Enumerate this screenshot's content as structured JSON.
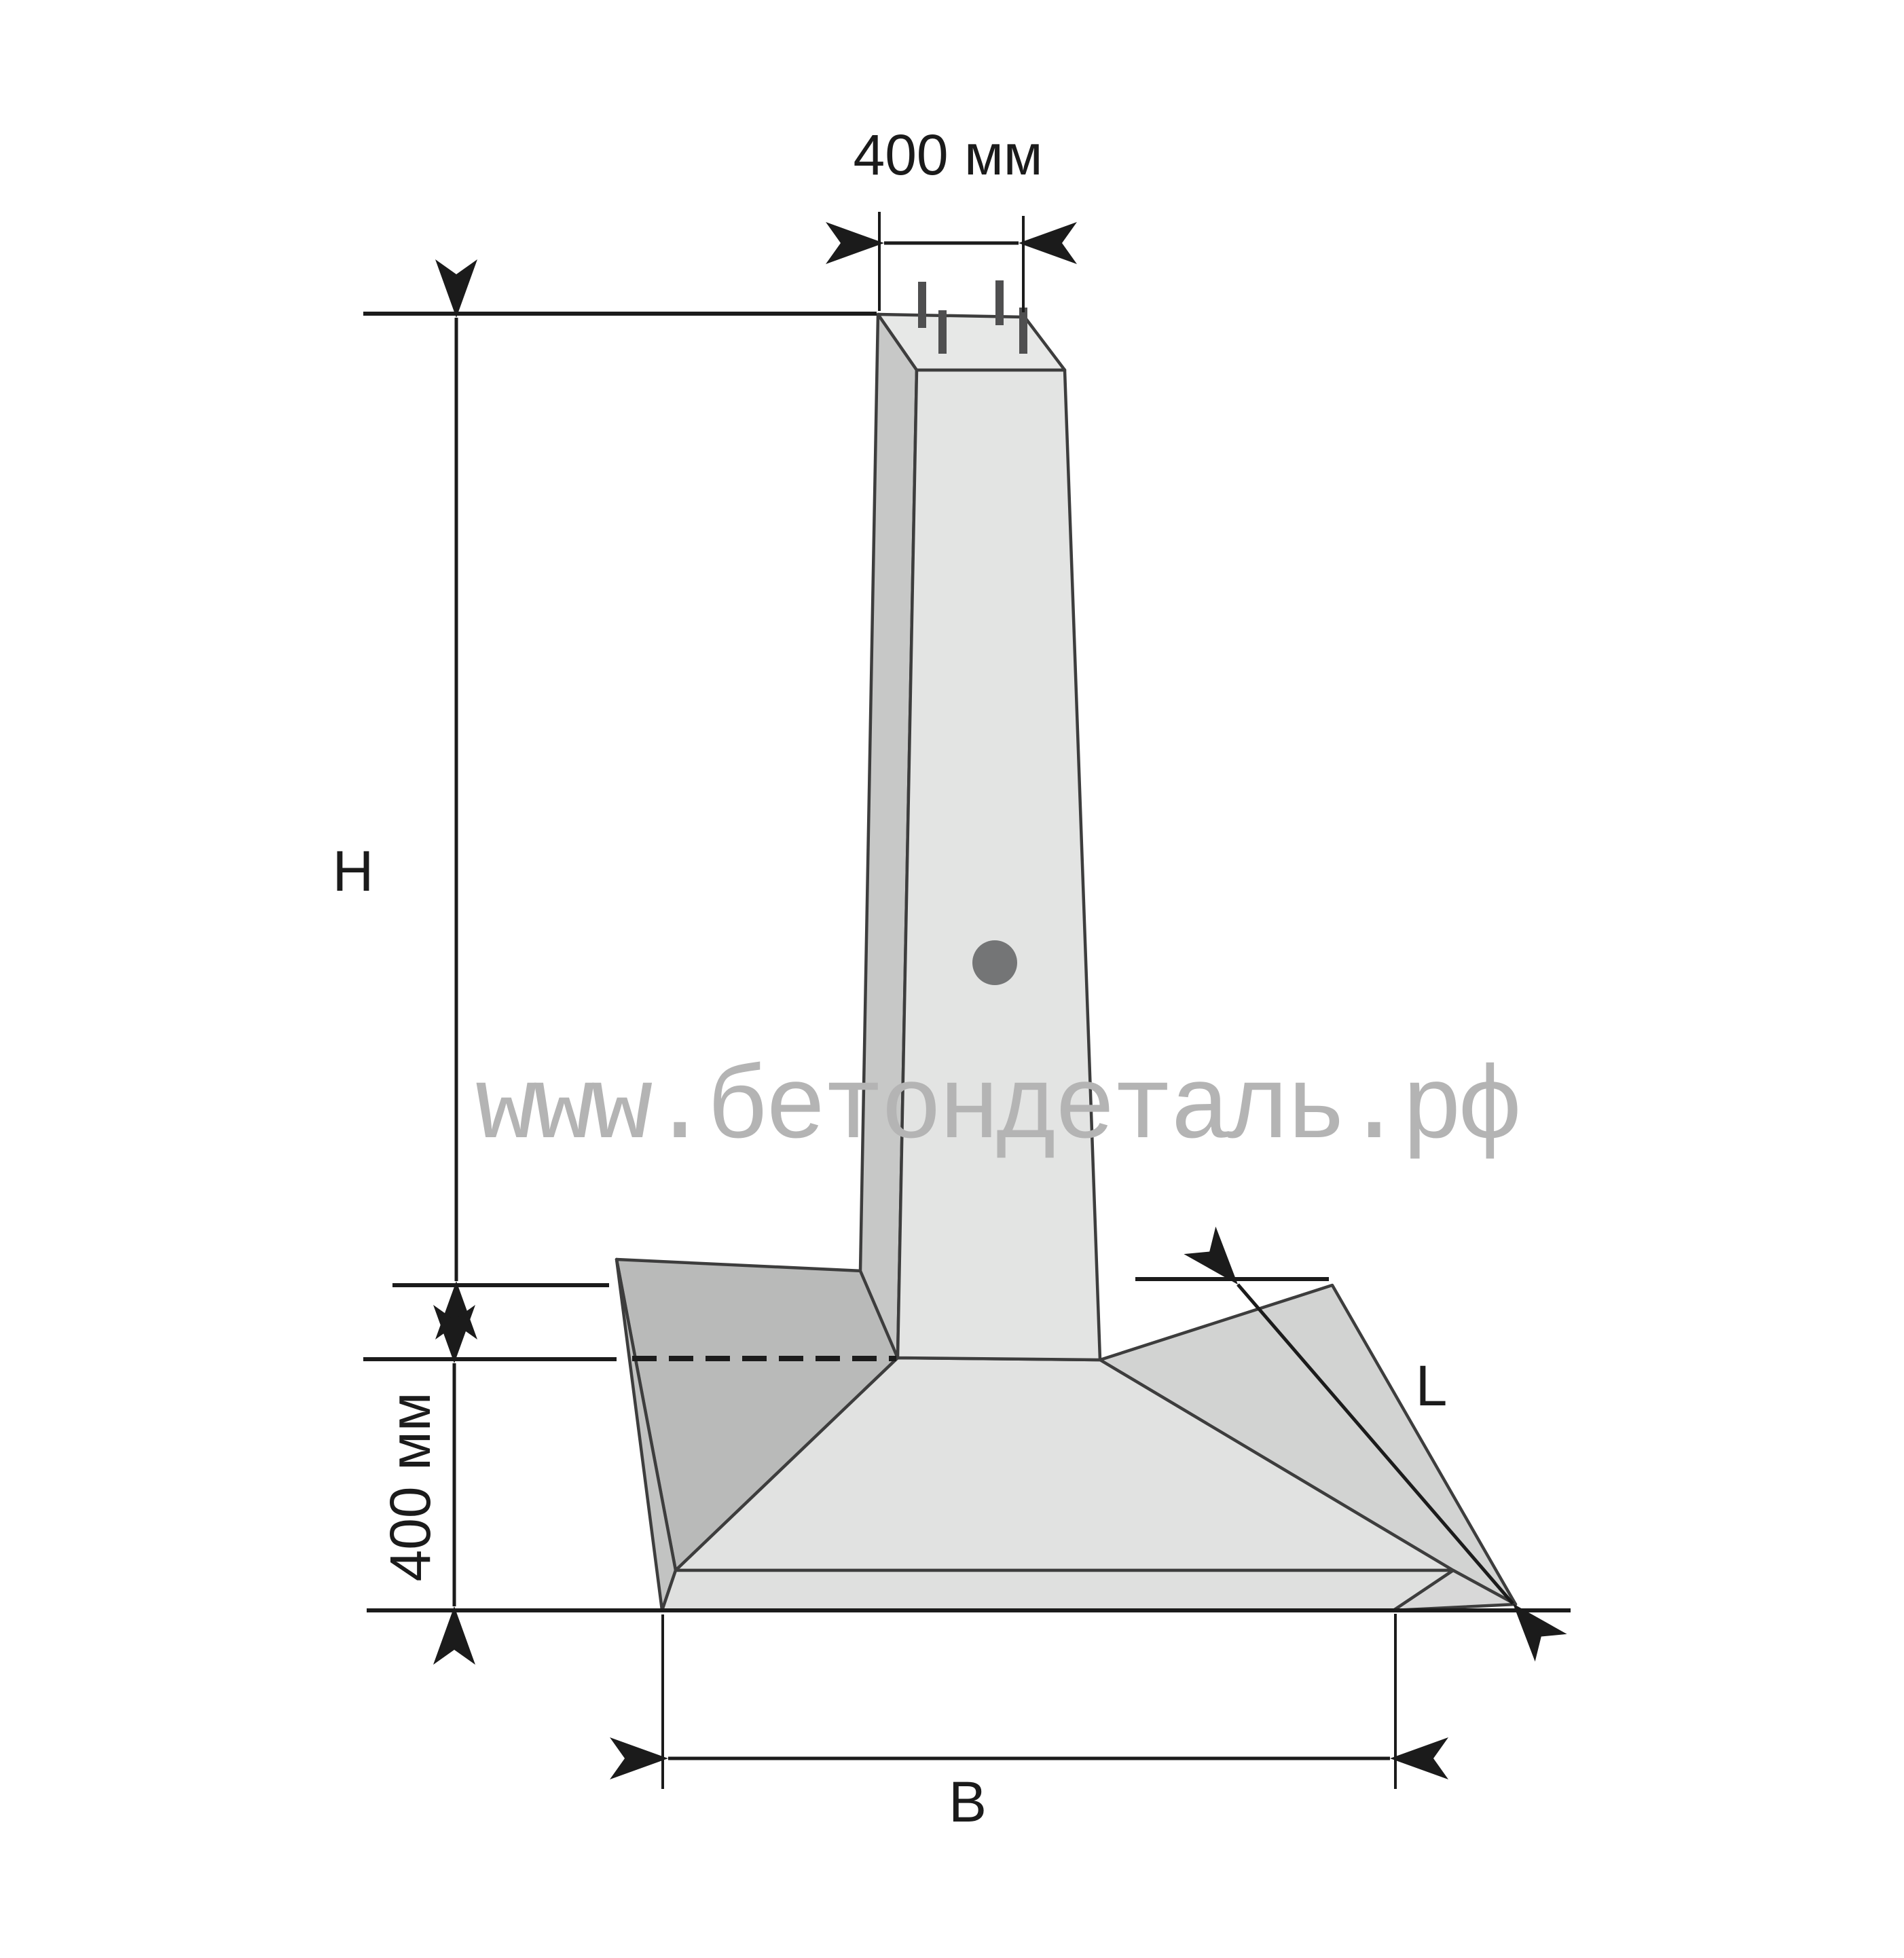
{
  "diagram": {
    "type": "technical-drawing",
    "subject": "precast concrete pier foundation (column footing), axonometric view",
    "labels": {
      "dim_top_width": "400 мм",
      "dim_height": "H",
      "dim_slab_thickness": "400 мм",
      "dim_base_width": "B",
      "dim_base_depth": "L"
    },
    "watermark": "www.бетондеталь.рф",
    "colors": {
      "background": "#ffffff",
      "ink": "#1b1b1b",
      "edge": "#3d3d3d",
      "face_top": "#e7e8e7",
      "face_front": "#e3e4e3",
      "face_side": "#c7c8c7",
      "slope_left": "#b9bab9",
      "slope_front": "#e1e2e1",
      "slope_right": "#d2d3d2",
      "wedge_left": "#c2c3c2",
      "wedge_right": "#d8d8d8",
      "slab_front": "#dfe0df",
      "rebar": "#4f4f50",
      "lifting_hole": "#747576",
      "watermark": "#b4b4b4"
    }
  }
}
